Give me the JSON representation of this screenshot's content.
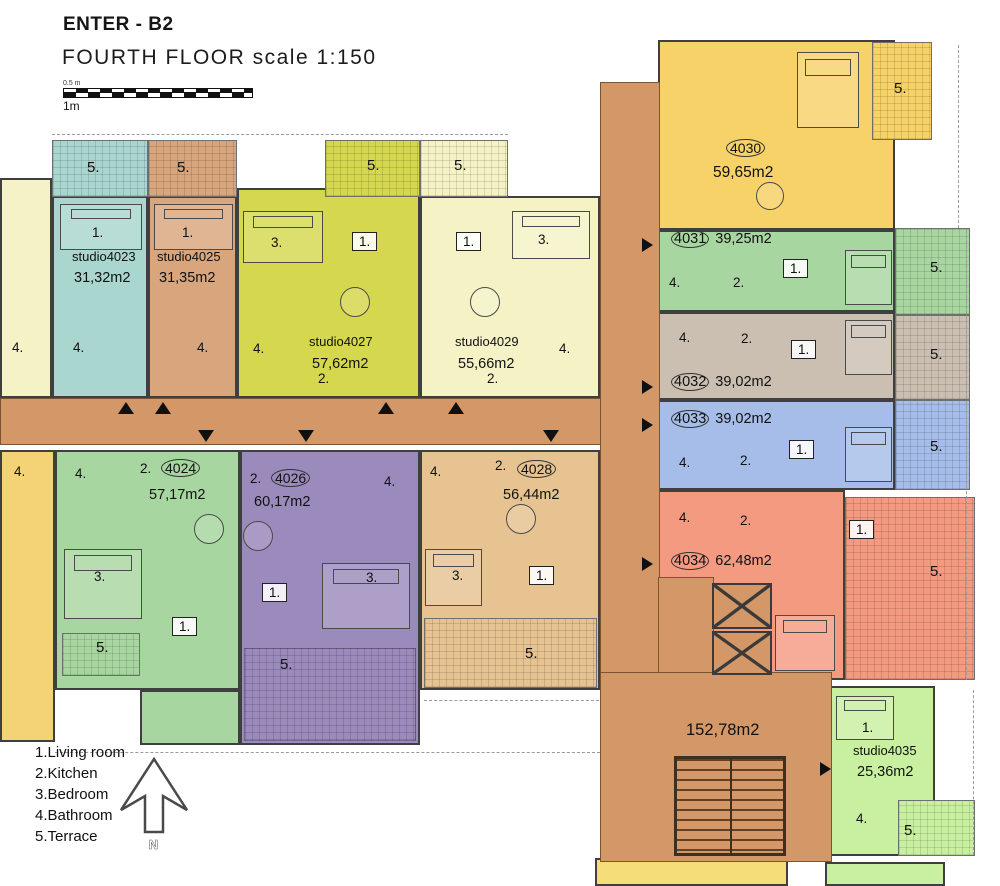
{
  "header": {
    "title": "ENTER - B2",
    "subtitle": "FOURTH FLOOR scale 1:150"
  },
  "scale_bar": {
    "top_label": "0.5 m",
    "bottom_label": "1m"
  },
  "legend": {
    "items": [
      "1.Living room",
      "2.Kitchen",
      "3.Bedroom",
      "4.Bathroom",
      "5.Terrace"
    ],
    "north_label": "N"
  },
  "corridor": {
    "area": "152,78m2",
    "color": "#d49868"
  },
  "units": {
    "left_top": {
      "color": "#f5f3c5",
      "rooms": {
        "r4": "4."
      }
    },
    "u4023": {
      "name": "studio4023",
      "area": "31,32m2",
      "color": "#a9d6ce",
      "rooms": {
        "r5": "5.",
        "r1": "1.",
        "r4": "4."
      }
    },
    "u4025": {
      "name": "studio4025",
      "area": "31,35m2",
      "color": "#d8a57c",
      "rooms": {
        "r5": "5.",
        "r1": "1.",
        "r4": "4."
      }
    },
    "u4027": {
      "name": "studio4027",
      "area": "57,62m2",
      "color": "#d5d84e",
      "rooms": {
        "r5": "5.",
        "r3": "3.",
        "r1": "1.",
        "r4": "4.",
        "r2": "2."
      }
    },
    "u4029": {
      "name": "studio4029",
      "area": "55,66m2",
      "color": "#f5f3c5",
      "rooms": {
        "r5": "5.",
        "r1": "1.",
        "r3": "3.",
        "r4": "4.",
        "r2": "2."
      }
    },
    "u4030": {
      "number": "4030",
      "area": "59,65m2",
      "color": "#f6d268",
      "rooms": {
        "r5": "5."
      }
    },
    "u4031": {
      "number": "4031",
      "area": "39,25m2",
      "color": "#a8d6a0",
      "rooms": {
        "r4": "4.",
        "r2": "2.",
        "r1": "1.",
        "r5": "5."
      }
    },
    "u4032": {
      "number": "4032",
      "area": "39,02m2",
      "color": "#cbbfb1",
      "rooms": {
        "r4": "4.",
        "r2": "2.",
        "r1": "1.",
        "r5": "5."
      }
    },
    "u4033": {
      "number": "4033",
      "area": "39,02m2",
      "color": "#a5bde8",
      "rooms": {
        "r4": "4.",
        "r2": "2.",
        "r1": "1.",
        "r5": "5."
      }
    },
    "u4034": {
      "number": "4034",
      "area": "62,48m2",
      "color": "#f49a80",
      "rooms": {
        "r4": "4.",
        "r2": "2.",
        "r1": "1.",
        "r5": "5."
      }
    },
    "u4035": {
      "name": "studio4035",
      "area": "25,36m2",
      "color": "#c8f0a0",
      "rooms": {
        "r1": "1.",
        "r4": "4.",
        "r5": "5."
      }
    },
    "u4024": {
      "number": "4024",
      "area": "57,17m2",
      "color": "#a8d6a0",
      "rooms": {
        "r2": "2.",
        "r4": "4.",
        "r3": "3.",
        "r1": "1.",
        "r5": "5."
      }
    },
    "u4026": {
      "number": "4026",
      "area": "60,17m2",
      "color": "#9b8abc",
      "rooms": {
        "r2": "2.",
        "r4": "4.",
        "r3": "3.",
        "r1": "1.",
        "r5": "5."
      }
    },
    "u4028": {
      "number": "4028",
      "area": "56,44m2",
      "color": "#e6c391",
      "rooms": {
        "r2": "2.",
        "r4": "4.",
        "r3": "3.",
        "r1": "1.",
        "r5": "5."
      }
    },
    "left_bottom": {
      "color": "#f3d376",
      "rooms": {
        "r4": "4."
      }
    },
    "bottom_yellow": {
      "color": "#f5dd7a"
    },
    "bottom_green": {
      "color": "#c8f0a0"
    }
  }
}
